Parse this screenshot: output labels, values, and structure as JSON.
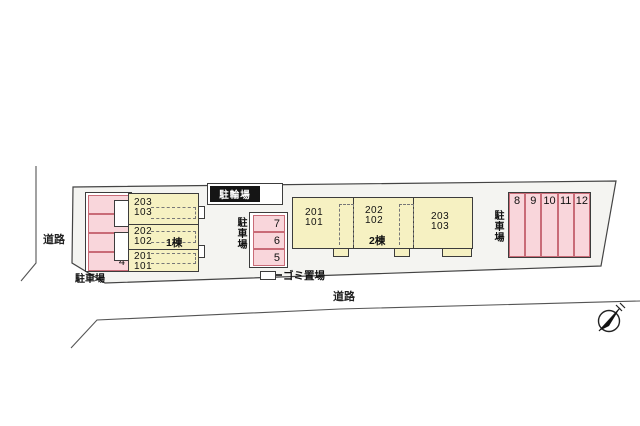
{
  "canvas": {
    "width": 640,
    "height": 426
  },
  "colors": {
    "space_fill": "#f9d6db",
    "space_border": "#c96b77",
    "building_fill": "#f6f1c2",
    "line": "#3c3c3c",
    "label_box_bg": "#151515"
  },
  "roads": {
    "left_label": "道路",
    "bottom_label": "道路"
  },
  "bicycle_parking": {
    "label": "駐輪場"
  },
  "garbage": {
    "label": "ゴミ置場"
  },
  "buildings": {
    "building1": {
      "name": "1棟",
      "units": [
        {
          "upper": "203",
          "lower": "103"
        },
        {
          "upper": "202",
          "lower": "102"
        },
        {
          "upper": "201",
          "lower": "101"
        }
      ]
    },
    "building2": {
      "name": "2棟",
      "units": [
        {
          "upper": "201",
          "lower": "101"
        },
        {
          "upper": "202",
          "lower": "102"
        },
        {
          "upper": "203",
          "lower": "103"
        }
      ]
    }
  },
  "parking": {
    "left": {
      "label": "駐車場",
      "spaces": [
        "1",
        "2",
        "3",
        "4"
      ]
    },
    "middle": {
      "label": "駐車場",
      "spaces": [
        "7",
        "6",
        "5"
      ]
    },
    "right": {
      "label": "駐車場",
      "spaces": [
        "8",
        "9",
        "10",
        "11",
        "12"
      ]
    }
  }
}
